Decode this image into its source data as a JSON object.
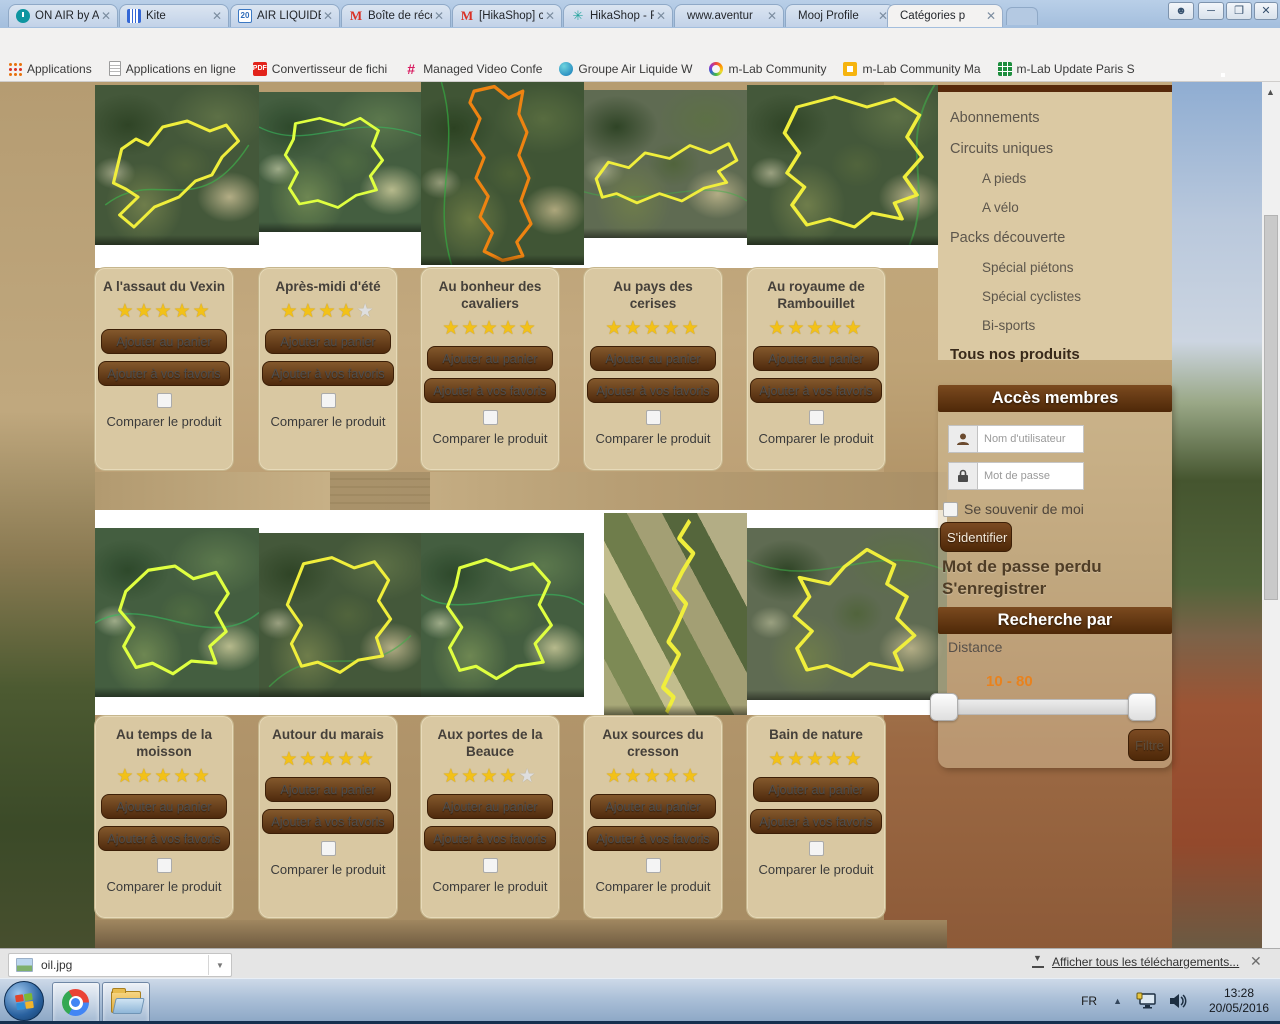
{
  "browser": {
    "tabs": [
      {
        "label": "ON AIR by A",
        "icon": "power-icon"
      },
      {
        "label": "Kite",
        "icon": "columns-icon"
      },
      {
        "label": "AIR LIQUIDE",
        "icon": "calendar-20-icon"
      },
      {
        "label": "Boîte de réce",
        "icon": "gmail-icon"
      },
      {
        "label": "[HikaShop] c",
        "icon": "gmail-icon"
      },
      {
        "label": "HikaShop - F",
        "icon": "hikashop-icon"
      },
      {
        "label": "www.aventur",
        "icon": "none"
      },
      {
        "label": "Mooj Profile",
        "icon": "none"
      },
      {
        "label": "Catégories p",
        "icon": "none"
      }
    ],
    "url_domain": "aventures-culturelles.com",
    "url_path": "/nos-produits",
    "bookmarks": [
      "Applications",
      "Applications en ligne",
      "Convertisseur de fichi",
      "Managed Video Confe",
      "Groupe Air Liquide W",
      "m-Lab Community",
      "m-Lab Community Ma",
      "m-Lab Update Paris S"
    ]
  },
  "shop": {
    "labels": {
      "cart": "Ajouter au panier",
      "fav": "Ajouter à vos favoris",
      "compare": "Comparer le produit"
    },
    "products": [
      {
        "name": "A l'assaut du Vexin",
        "rating": 5,
        "color": "#f0ee3c",
        "route": "M18 98 26 64 40 54 52 60 66 42 90 36 112 46 128 40 140 56 124 72 114 90 98 96 82 112 58 122 38 142 24 130 42 112 30 104 Z"
      },
      {
        "name": "Après-midi d'été",
        "rating": 4,
        "color": "#f0ee3c",
        "route": "M36 36 60 30 84 38 100 30 118 44 112 62 122 78 110 96 116 112 96 118 78 132 58 124 40 128 30 110 38 92 26 72 34 54 Z"
      },
      {
        "name": "Au bonheur des cavaliers",
        "rating": 5,
        "color": "#ef8a1e",
        "route": "M52 8 72 4 86 14 100 8 96 28 104 44 96 64 106 84 98 104 108 124 94 140 100 152 80 156 62 148 70 132 58 118 66 100 54 84 62 66 50 50 58 32 48 18 Z"
      },
      {
        "name": "Au pays des cerises",
        "rating": 5,
        "color": "#f0ee3c",
        "route": "M12 96 24 78 44 84 60 68 84 74 104 60 124 68 142 58 150 76 132 88 140 100 118 106 96 120 74 112 52 122 32 112 18 116 Z"
      },
      {
        "name": "Au royaume de Rambouillet",
        "rating": 5,
        "color": "#f0ee3c",
        "route": "M40 22 70 12 96 22 118 14 138 30 128 52 140 72 126 92 136 110 118 118 124 134 100 128 86 142 66 134 48 140 36 120 46 102 32 88 42 68 30 48 Z"
      },
      {
        "name": "Au temps de la moisson",
        "rating": 5,
        "color": "#f0ee3c",
        "route": "M30 60 52 40 78 36 96 48 118 42 130 62 118 80 128 98 112 112 118 128 94 126 76 138 56 128 40 132 28 112 38 94 24 78 Z"
      },
      {
        "name": "Autour du marais",
        "rating": 5,
        "color": "#f0ee3c",
        "route": "M44 30 72 24 94 34 114 28 128 46 118 66 130 84 116 102 122 120 98 124 80 136 58 126 42 130 32 108 42 90 28 70 36 50 Z"
      },
      {
        "name": "Aux portes de la Beauce",
        "rating": 4,
        "color": "#f0ee3c",
        "route": "M38 34 64 26 88 36 110 30 126 48 116 70 128 90 112 108 120 126 94 130 74 142 54 130 38 134 28 112 40 92 26 72 34 52 Z"
      },
      {
        "name": "Aux sources du cresson",
        "rating": 5,
        "color": "#f0ee3c",
        "route": "M96 6 84 20 100 32 88 46 78 60 92 72 82 88 72 102 84 112 74 126 66 138 78 146 70 158"
      },
      {
        "name": "Bain de nature",
        "rating": 5,
        "color": "#f0ee3c",
        "route": "M96 20 118 34 112 52 128 64 120 84 134 100 118 116 124 132 98 126 84 138 64 128 48 132 40 112 52 96 38 82 50 64 42 46 66 52 78 36 Z"
      }
    ]
  },
  "sidebar": {
    "categories": [
      "Abonnements",
      "Circuits uniques",
      "A pieds",
      "A vélo",
      "Packs découverte",
      "Spécial piétons",
      "Spécial cyclistes",
      "Bi-sports"
    ],
    "all_products": "Tous nos produits",
    "members": {
      "title": "Accès membres",
      "user_ph": "Nom d'utilisateur",
      "pass_ph": "Mot de passe",
      "remember": "Se souvenir de moi",
      "login": "S'identifier",
      "lost": "Mot de passe perdu",
      "register": "S'enregistrer"
    },
    "search": {
      "title": "Recherche par",
      "distance": "Distance",
      "range": "10 - 80",
      "filter": "Filtre"
    }
  },
  "downloads": {
    "file": "oil.jpg",
    "show_all": "Afficher tous les téléchargements..."
  },
  "taskbar": {
    "lang": "FR",
    "time": "13:28",
    "date": "20/05/2016"
  }
}
